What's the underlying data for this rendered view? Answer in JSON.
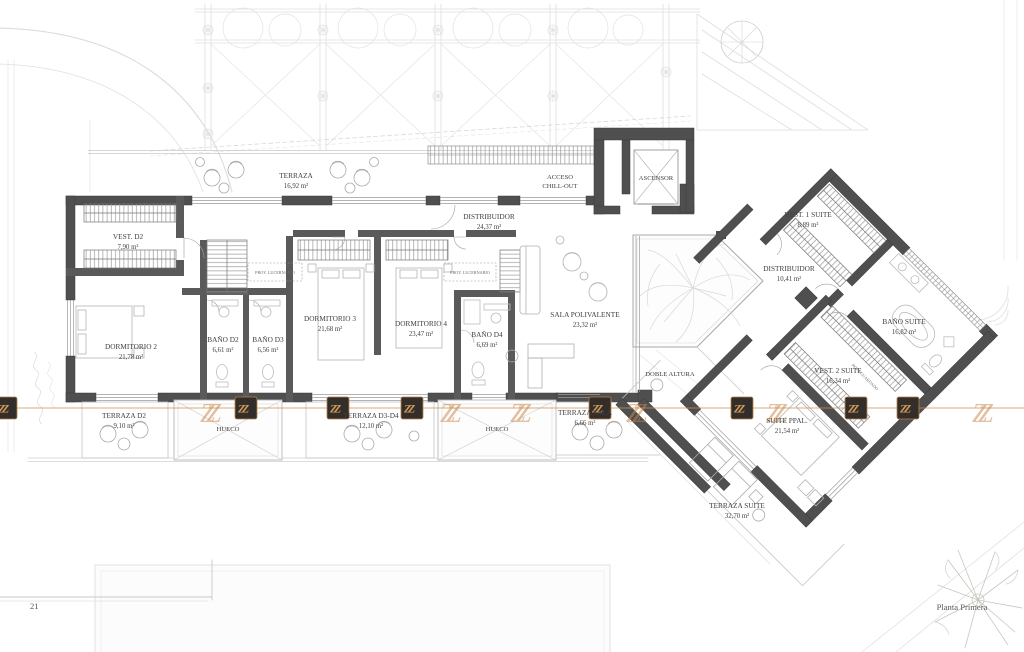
{
  "plan": {
    "sheet_number": "21",
    "title": "Planta Primera"
  },
  "watermark": {
    "logo": "ZZ"
  },
  "rooms": [
    {
      "name": "TERRAZA",
      "area": "16,92 m²"
    },
    {
      "name": "VEST. D2",
      "area": "7,90 m²"
    },
    {
      "name": "DORMITORIO 2",
      "area": "21,78 m²"
    },
    {
      "name": "BAÑO D2",
      "area": "6,61 m²"
    },
    {
      "name": "BAÑO D3",
      "area": "6,56 m²"
    },
    {
      "name": "DORMITORIO 3",
      "area": "21,68 m²"
    },
    {
      "name": "DORMITORIO 4",
      "area": "23,47 m²"
    },
    {
      "name": "BAÑO D4",
      "area": "6,69 m²"
    },
    {
      "name": "DISTRIBUIDOR",
      "area": "24,37 m²"
    },
    {
      "name": "SALA POLIVALENTE",
      "area": "23,32 m²"
    },
    {
      "name": "VEST. 1 SUITE",
      "area": "8,89 m²"
    },
    {
      "name": "DISTRIBUIDOR",
      "area": "10,41 m²"
    },
    {
      "name": "BAÑO SUITE",
      "area": "16,82 m²"
    },
    {
      "name": "VEST. 2 SUITE",
      "area": "16,34 m²"
    },
    {
      "name": "SUITE PPAL.",
      "area": "21,54 m²"
    },
    {
      "name": "TERRAZA SUITE",
      "area": "32,70 m²"
    },
    {
      "name": "TERRAZA D2",
      "area": "9,10 m²"
    },
    {
      "name": "TERRAZA D3-D4",
      "area": "12,10 m²"
    },
    {
      "name": "TERRAZA SALA",
      "area": "6,66 m²"
    }
  ],
  "annotations": {
    "acceso_line1": "ACCESO",
    "acceso_line2": "CHILL-OUT",
    "ascensor": "ASCENSOR",
    "doble_altura": "DOBLE ALTURA",
    "hueco": "HUECO",
    "proy_lucernario": "PROY. LUCERNARIO",
    "guardado": "ROPA GUARDADO"
  },
  "colors": {
    "wall": "#4f4f4f",
    "watermark_line": "#cd9051",
    "watermark_logo": "#c8884c",
    "label_text": "#404040"
  }
}
